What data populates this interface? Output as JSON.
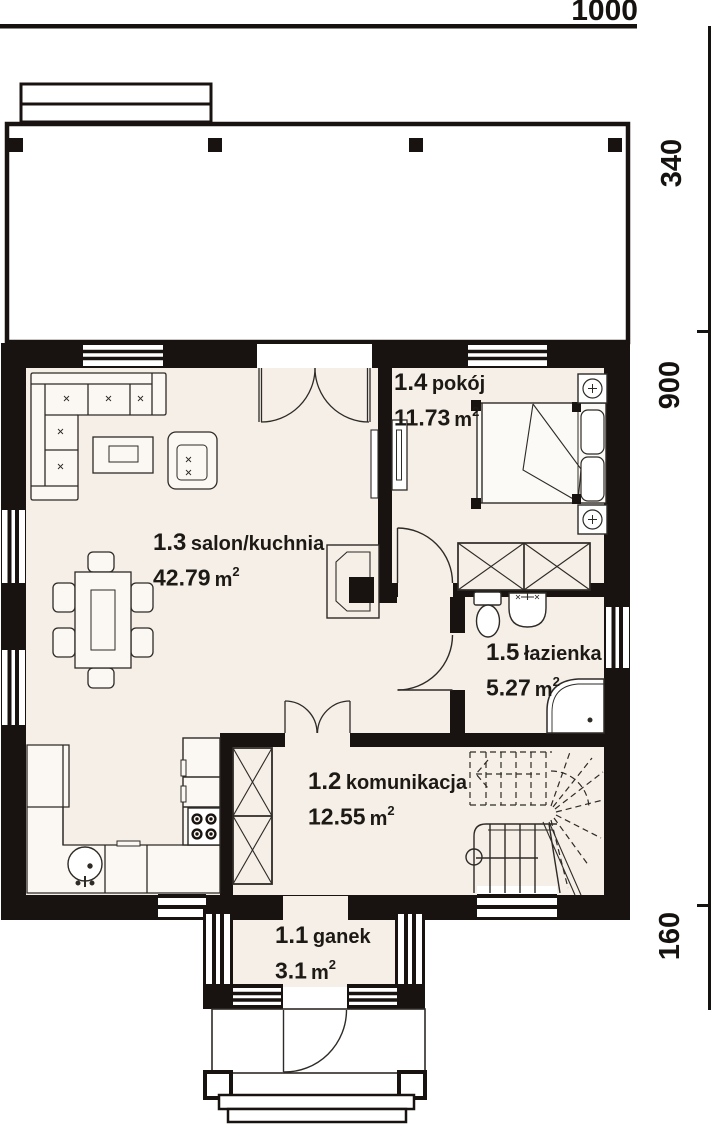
{
  "plan_title": "parter - rzut",
  "dimensions": {
    "top": "1000",
    "right": [
      "340",
      "900",
      "160"
    ]
  },
  "units": {
    "symbol": "m",
    "exp": "2"
  },
  "rooms": [
    {
      "number": "1.1",
      "name": "ganek",
      "area": "3.1"
    },
    {
      "number": "1.2",
      "name": "komunikacja",
      "area": "12.55"
    },
    {
      "number": "1.3",
      "name": "salon/kuchnia",
      "area": "42.79"
    },
    {
      "number": "1.4",
      "name": "pokój",
      "area": "11.73"
    },
    {
      "number": "1.5",
      "name": "łazienka",
      "area": "5.27"
    }
  ],
  "colors": {
    "background": "#ffffff",
    "wall": "#181310",
    "floor": "#f5efe8",
    "furniture_fill": "#fbf8f3",
    "stroke": "#2e2a26"
  }
}
